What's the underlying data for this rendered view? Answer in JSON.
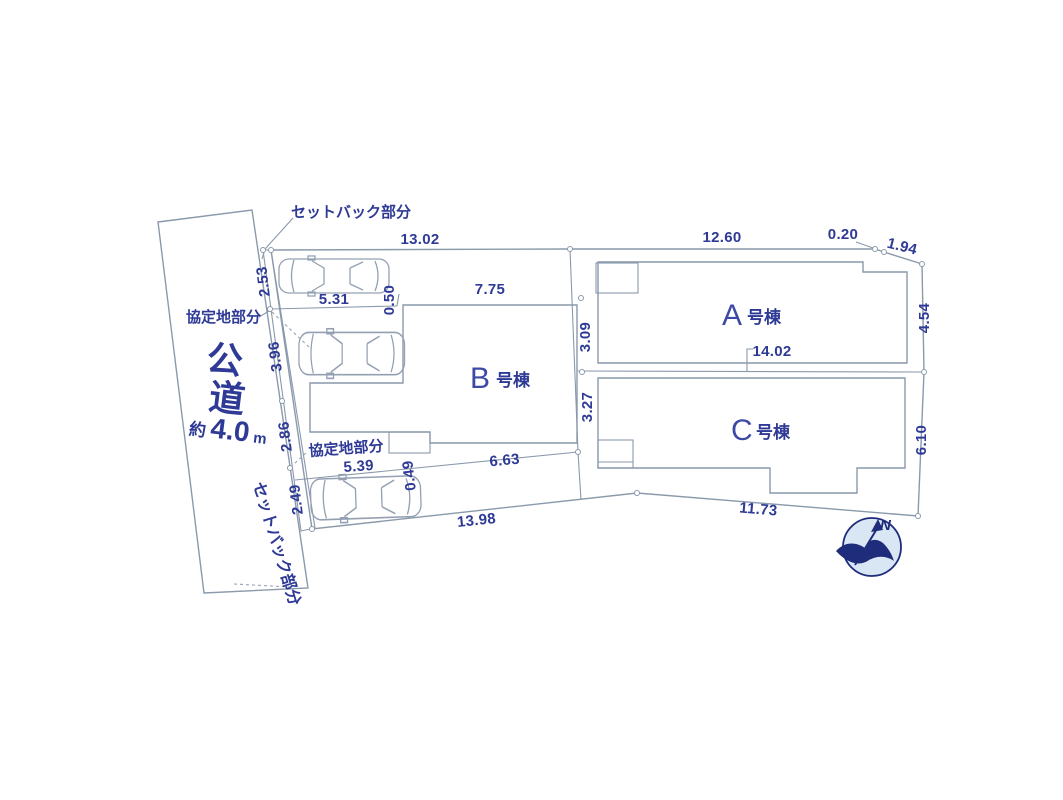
{
  "drawing": {
    "labels": {
      "setback_top": "セットバック部分",
      "setback_bottom": "セットバック部分",
      "agreement_top": "協定地部分",
      "agreement_bottom": "協定地部分"
    },
    "road": {
      "name_char1": "公",
      "name_char2": "道",
      "approx_prefix": "約",
      "width_value": "4.0",
      "width_unit": "m"
    },
    "buildings": {
      "a": {
        "letter": "A",
        "suffix": "号棟"
      },
      "b": {
        "letter": "B",
        "suffix": "号棟"
      },
      "c": {
        "letter": "C",
        "suffix": "号棟"
      }
    },
    "dimensions": {
      "top_left": "13.02",
      "top_right": "12.60",
      "top_jog": "0.20",
      "top_diag": "1.94",
      "left_1": "2.53",
      "left_2": "3.96",
      "left_3": "2.86",
      "left_4": "2.49",
      "car_top_width": "5.31",
      "offset_top": "0.50",
      "b_top_width": "7.75",
      "divider_a": "3.09",
      "divider_c": "3.27",
      "a_width": "14.02",
      "right_a": "4.54",
      "right_c": "6.10",
      "bottom_inner_left": "5.39",
      "bottom_inner_offset": "0.49",
      "bottom_inner_right": "6.63",
      "bottom_left": "13.98",
      "bottom_right": "11.73"
    },
    "compass": {
      "north": "N"
    },
    "colors": {
      "plot_green": "#dde8cf",
      "boundary_line": "#8a99ab",
      "text_navy": "#2e3a96",
      "road_fill": "#f4f4f2",
      "compass_fill": "#d9e7f4",
      "compass_navy": "#1f2b7b"
    }
  }
}
